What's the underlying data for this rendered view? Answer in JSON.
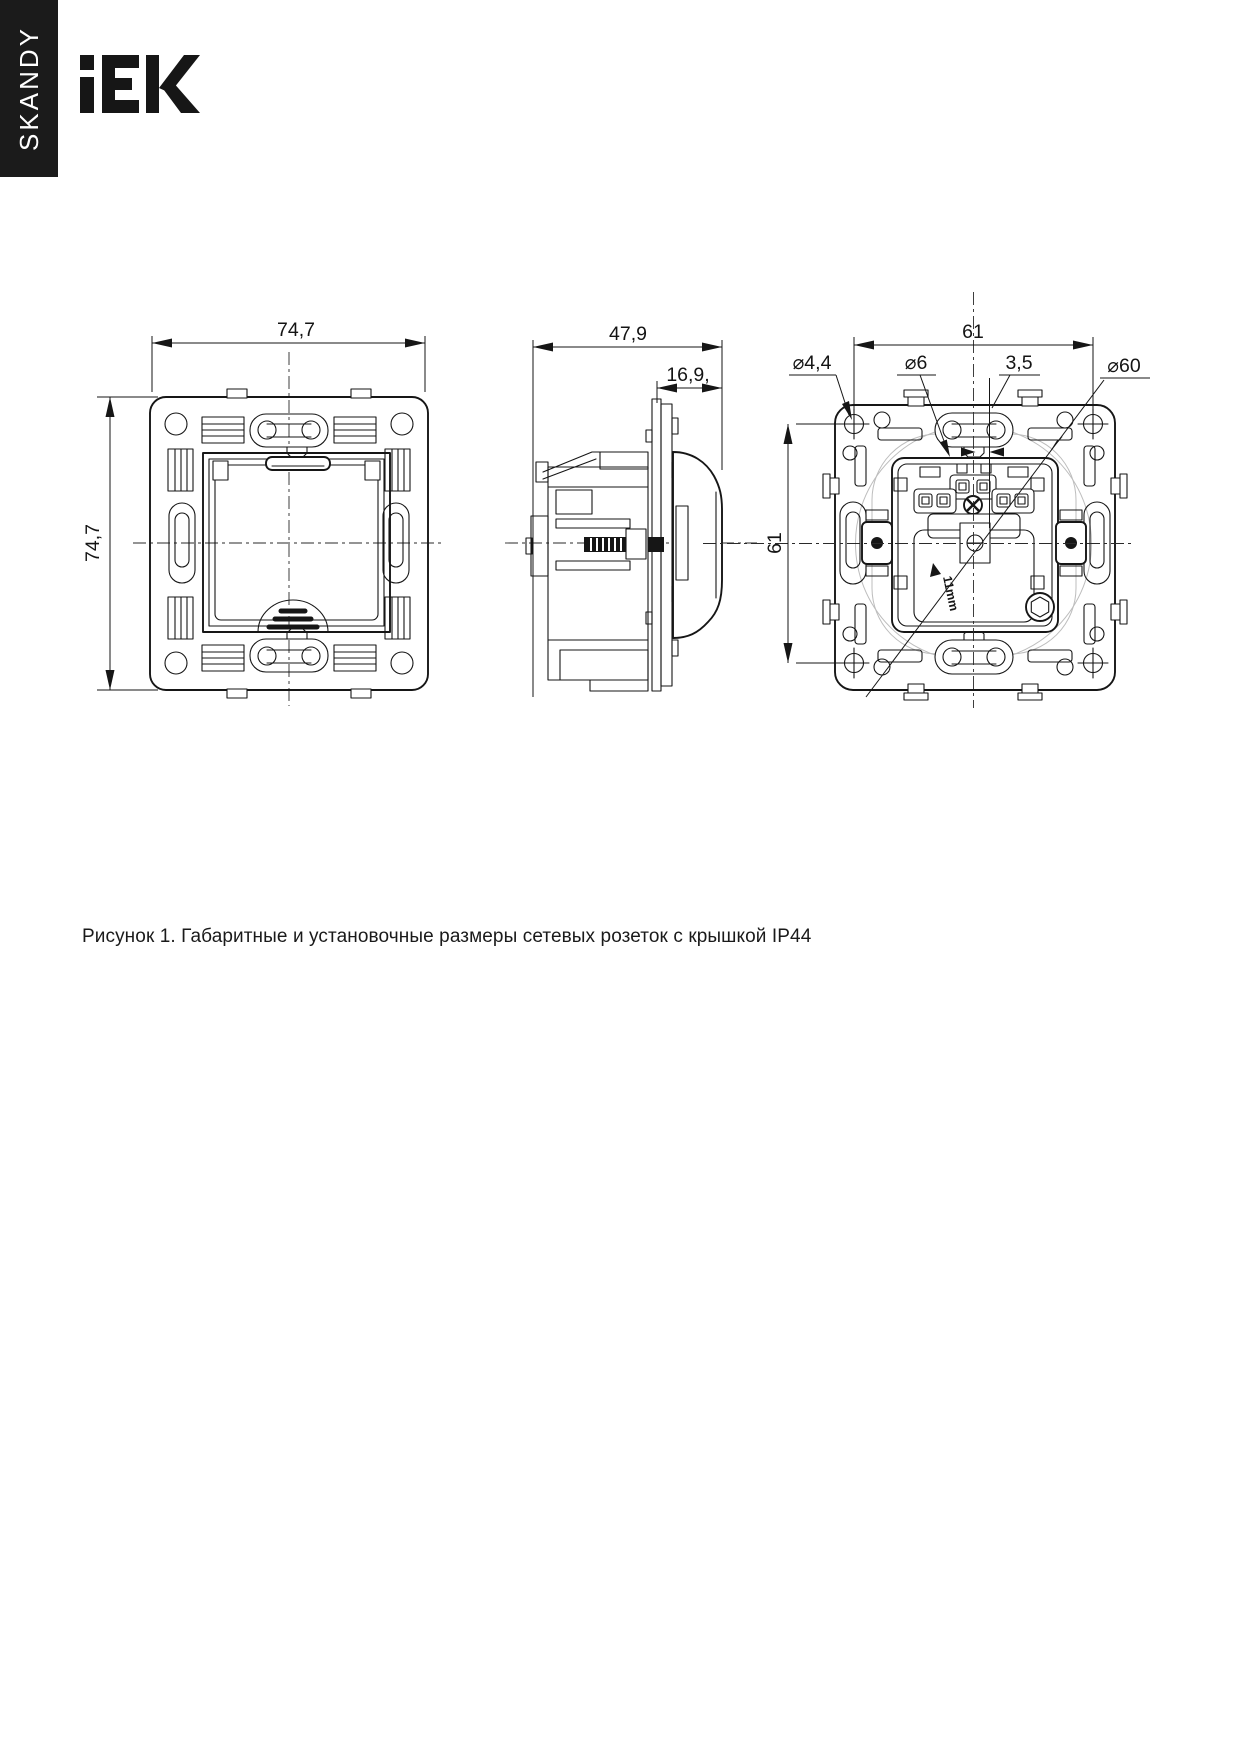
{
  "sidebar": {
    "series_label": "SKANDY"
  },
  "header": {
    "brand": "IEK"
  },
  "caption": {
    "text": "Рисунок 1. Габаритные и установочные размеры сетевых розеток с крышкой IP44"
  },
  "views": {
    "front": {
      "width": "74,7",
      "height": "74,7"
    },
    "side": {
      "depth": "47,9",
      "protrusion": "16,9,"
    },
    "back": {
      "width": "61",
      "height": "61",
      "mount_hole": "⌀4,4",
      "screw_hole": "⌀6",
      "offset": "3,5",
      "install_circle": "⌀60",
      "terminal_left": "L",
      "terminal_right": "N",
      "claw_note": "11mm"
    }
  },
  "colors": {
    "ink": "#161616",
    "banner": "#1b1b1b",
    "ghost": "#bdbdbd"
  }
}
